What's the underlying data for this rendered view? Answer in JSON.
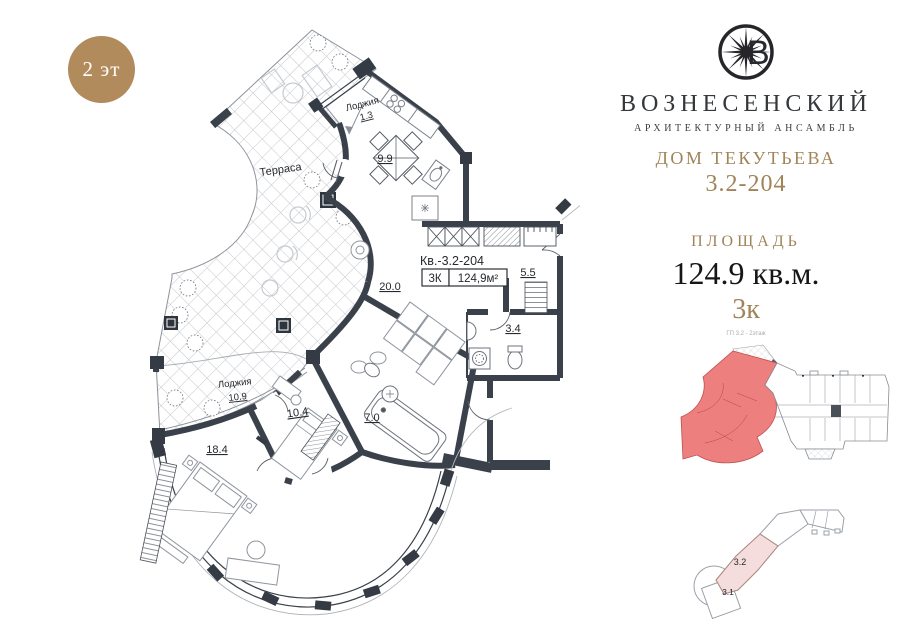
{
  "badge": {
    "label": "2 эт"
  },
  "brand": {
    "name": "ВОЗНЕСЕНСКИЙ",
    "tagline": "АРХИТЕКТУРНЫЙ АНСАМБЛЬ",
    "building": "ДОМ ТЕКУТЬЕВА",
    "unit": "3.2-204",
    "logo_icon": "compass-rose-with-letter-В"
  },
  "area": {
    "title": "ПЛОЩАДЬ",
    "value": "124.9 кв.м.",
    "rooms": "3к"
  },
  "plan": {
    "apartment_no": "Кв.-3.2-204",
    "rooms_code": "3К",
    "total_area": "124,9м²",
    "labels": {
      "terrace": "Терраса",
      "loggia_top_name": "Лоджия",
      "loggia_top_area": "1.3",
      "kitchen_area": "9.9",
      "living_area": "20.0",
      "hall_area": "5.5",
      "wc_area": "3.4",
      "loggia_bottom_name": "Лоджия",
      "loggia_bottom_area": "10.9",
      "bedroom2_area": "10.4",
      "bath_area": "7.0",
      "bedroom1_area": "18.4"
    }
  },
  "floorplate": {
    "caption": "ГП 3.2 - 2этаж"
  },
  "siteplan": {
    "highlight_label": "3.2",
    "secondary_label": "3.1"
  },
  "colors": {
    "gold": "#a08458",
    "badge": "#b28b5d",
    "wall": "#3a414b",
    "unit_red": "#ed7f7f",
    "site_pink": "#f6dddd"
  }
}
